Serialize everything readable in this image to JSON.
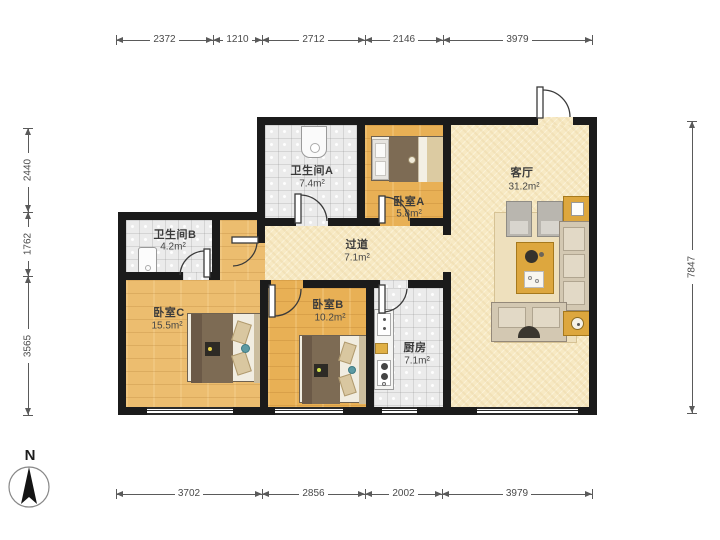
{
  "compass": {
    "label": "N"
  },
  "dimensions": {
    "top": [
      "2372",
      "1210",
      "2712",
      "2146",
      "3979"
    ],
    "bottom": [
      "3702",
      "2856",
      "2002",
      "3979"
    ],
    "left": [
      "2440",
      "1762",
      "3565"
    ],
    "right": [
      "7847"
    ]
  },
  "rooms": {
    "bathA": {
      "name": "卫生间A",
      "area": "7.4m²"
    },
    "bedA": {
      "name": "卧室A",
      "area": "5.8m²"
    },
    "living": {
      "name": "客厅",
      "area": "31.2m²"
    },
    "hall": {
      "name": "过道",
      "area": "7.1m²"
    },
    "bathB": {
      "name": "卫生间B",
      "area": "4.2m²"
    },
    "bedC": {
      "name": "卧室C",
      "area": "15.5m²"
    },
    "bedB": {
      "name": "卧室B",
      "area": "10.2m²"
    },
    "kitchen": {
      "name": "厨房",
      "area": "7.1m²"
    }
  },
  "colors": {
    "wall": "#1b1b1b",
    "wood_floor": "#e8b055",
    "tile_floor": "#ebebeb",
    "living_floor": "#f7e9c3",
    "furniture_accent": "#dda73e",
    "dimension_line": "#5a5a5a"
  }
}
